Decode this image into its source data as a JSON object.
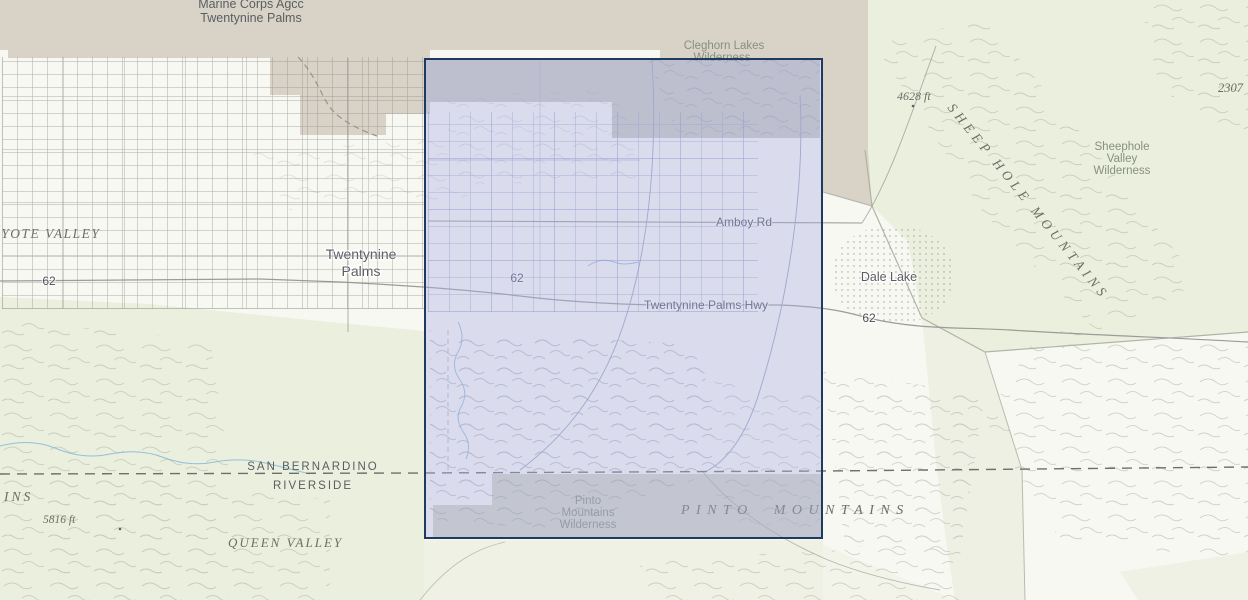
{
  "map": {
    "labels": {
      "military_base_line1": "Marine Corps Agcc",
      "military_base_line2": "Twentynine Palms",
      "cleghorn_line1": "Cleghorn Lakes",
      "cleghorn_line2": "Wilderness",
      "sheephole_valley_line1": "Sheephole",
      "sheephole_valley_line2": "Valley",
      "sheephole_valley_line3": "Wilderness",
      "sheep_hole_mountains": "SHEEP HOLE MOUNTAINS",
      "elevation_4628": "4628 ft",
      "elevation_2307": "2307",
      "elevation_5816": "5816 ft",
      "coyote_valley": "OYOTE VALLEY",
      "town_line1": "Twentynine",
      "town_line2": "Palms",
      "amboy_rd": "Amboy Rd",
      "twentynine_palms_hwy": "Twentynine Palms Hwy",
      "route_62": "62",
      "dale_lake": "Dale Lake",
      "county_top": "SAN BERNARDINO",
      "county_bottom": "RIVERSIDE",
      "pinto_wilderness_line1": "Pinto",
      "pinto_wilderness_line2": "Mountains",
      "pinto_wilderness_line3": "Wilderness",
      "pinto_mountains": "PINTO MOUNTAINS",
      "queen_valley": "QUEEN VALLEY",
      "mountains_name_partial": "INS"
    },
    "colors": {
      "selection_border": "#1e3a60",
      "selection_fill": "rgba(172,176,228,0.40)",
      "military_base_tan": "#d8d3c6",
      "wilderness_green": "#ebefde",
      "land_status_gray": "#c9cac2",
      "water_blue": "#85b7da"
    }
  }
}
